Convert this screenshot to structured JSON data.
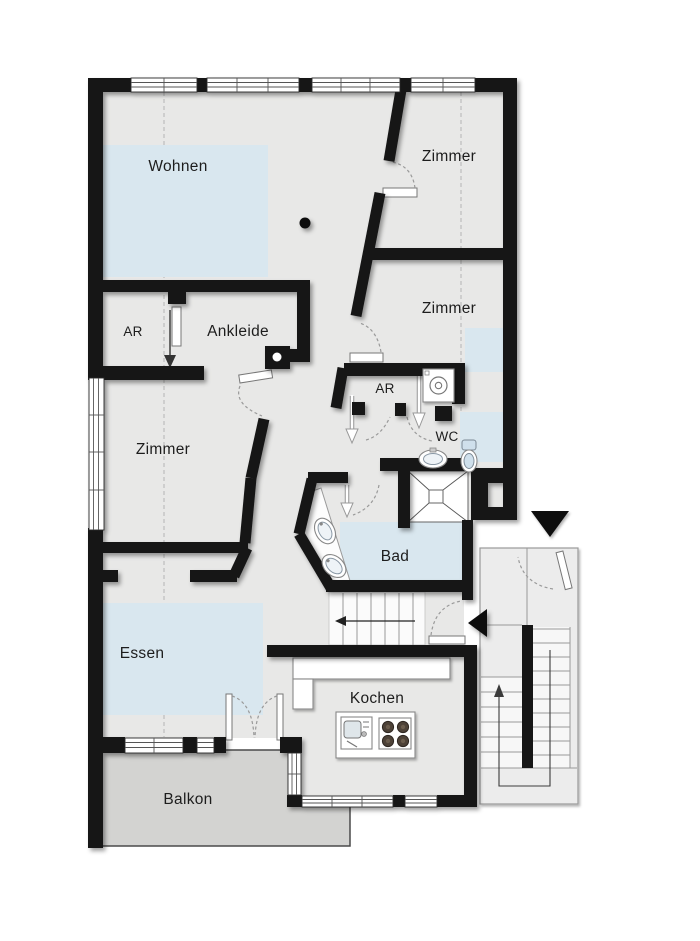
{
  "plan": {
    "type": "apartment-floor-plan",
    "rooms": [
      {
        "id": "wohnen",
        "label": "Wohnen"
      },
      {
        "id": "zimmer-top",
        "label": "Zimmer"
      },
      {
        "id": "zimmer-right",
        "label": "Zimmer"
      },
      {
        "id": "ar-left",
        "label": "AR"
      },
      {
        "id": "ankleide",
        "label": "Ankleide"
      },
      {
        "id": "zimmer-left",
        "label": "Zimmer"
      },
      {
        "id": "ar-right",
        "label": "AR"
      },
      {
        "id": "wc",
        "label": "WC"
      },
      {
        "id": "bad",
        "label": "Bad"
      },
      {
        "id": "essen",
        "label": "Essen"
      },
      {
        "id": "kochen",
        "label": "Kochen"
      },
      {
        "id": "balkon",
        "label": "Balkon"
      }
    ],
    "colors": {
      "wall": "#161616",
      "floor": "#e8e8e7",
      "room_highlight": "#d9e7ef",
      "balcony": "#d3d3d1",
      "stairwell": "#ececec",
      "section_dash": "#b5b5b5",
      "door_arc": "#9a9a9a",
      "label_text": "#1d1d1d"
    },
    "icons": {
      "building_entrance_marker": "filled-down-triangle",
      "apartment_entrance_marker": "filled-left-triangle",
      "stair_up_arrow": "thin-up-arrow",
      "stair_down_arrow": "thin-left-arrow",
      "sliding_door_arrow": "thin-down-arrow",
      "column": "filled-dot",
      "washing_machine": "square-with-circle",
      "shower": "square-with-x",
      "stove": "four-burner-hob",
      "kitchen_sink": "basin-with-faucet",
      "bathroom_sink": "oval-basin",
      "wc_sink": "oval-basin",
      "toilet": "toilet-top-view"
    }
  }
}
